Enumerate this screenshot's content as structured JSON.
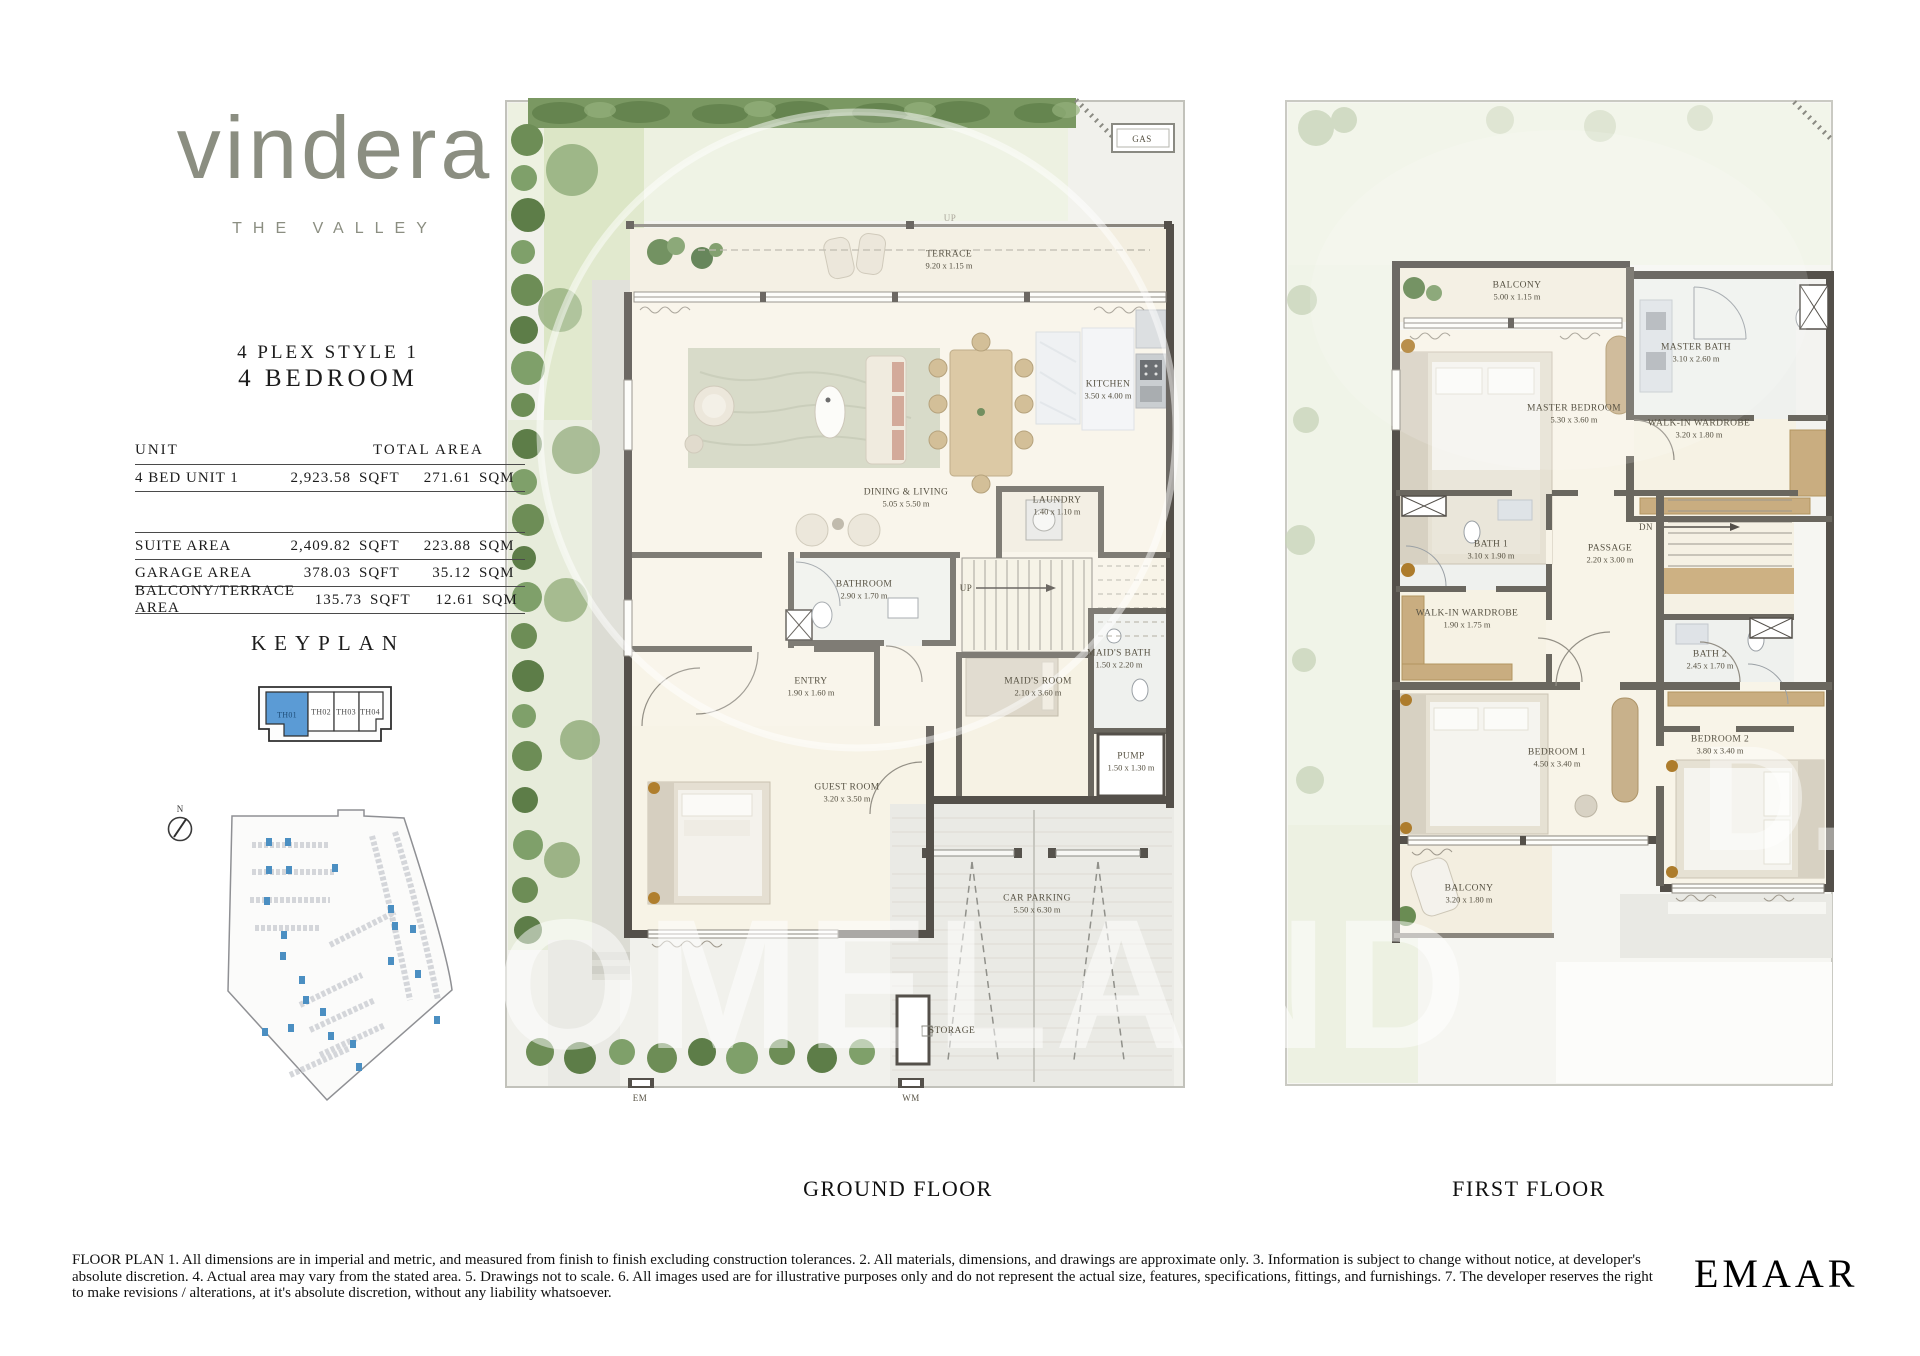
{
  "brand": {
    "logo": "vindera",
    "tagline": "THE VALLEY"
  },
  "header": {
    "style_line": "4 PLEX STYLE 1",
    "type_line": "4 BEDROOM"
  },
  "area_table": {
    "unit_header": "UNIT",
    "total_header": "TOTAL AREA",
    "unit_row": {
      "label": "4 BED UNIT 1",
      "sqft": "2,923.58",
      "sqft_unit": "SQFT",
      "sqm": "271.61",
      "sqm_unit": "SQM"
    },
    "detail_rows": [
      {
        "label": "SUITE AREA",
        "sqft": "2,409.82",
        "sqft_unit": "SQFT",
        "sqm": "223.88",
        "sqm_unit": "SQM"
      },
      {
        "label": "GARAGE AREA",
        "sqft": "378.03",
        "sqft_unit": "SQFT",
        "sqm": "35.12",
        "sqm_unit": "SQM"
      },
      {
        "label": "BALCONY/TERRACE AREA",
        "sqft": "135.73",
        "sqft_unit": "SQFT",
        "sqm": "12.61",
        "sqm_unit": "SQM"
      }
    ]
  },
  "keyplan": {
    "title": "KEYPLAN",
    "units": [
      {
        "id": "TH01"
      },
      {
        "id": "TH02"
      },
      {
        "id": "TH03"
      },
      {
        "id": "TH04"
      }
    ],
    "highlighted_unit": "TH01",
    "highlight_color": "#5b9bd5"
  },
  "compass": {
    "label": "N"
  },
  "ground_floor": {
    "title": "GROUND FLOOR",
    "rooms": [
      {
        "name": "TERRACE",
        "dims": "9.20 x 1.15 m"
      },
      {
        "name": "KITCHEN",
        "dims": "3.50 x 4.00 m"
      },
      {
        "name": "DINING & LIVING",
        "dims": "5.05 x 5.50 m"
      },
      {
        "name": "LAUNDRY",
        "dims": "1.40 x 1.10 m"
      },
      {
        "name": "BATHROOM",
        "dims": "2.90 x 1.70 m"
      },
      {
        "name": "ENTRY",
        "dims": "1.90 x 1.60 m"
      },
      {
        "name": "MAID'S ROOM",
        "dims": "2.10 x 3.60 m"
      },
      {
        "name": "MAID'S BATH",
        "dims": "1.50 x 2.20 m"
      },
      {
        "name": "PUMP",
        "dims": "1.50 x 1.30 m"
      },
      {
        "name": "GUEST ROOM",
        "dims": "3.20 x 3.50 m"
      },
      {
        "name": "CAR PARKING",
        "dims": "5.50 x 6.30 m"
      },
      {
        "name": "STORAGE"
      }
    ],
    "annotations": {
      "gas": "GAS",
      "up": "UP",
      "up_terrace": "UP",
      "em": "EM",
      "wm": "WM"
    }
  },
  "first_floor": {
    "title": "FIRST FLOOR",
    "rooms": [
      {
        "name": "BALCONY",
        "dims": "5.00 x 1.15 m"
      },
      {
        "name": "MASTER BATH",
        "dims": "3.10 x 2.60 m"
      },
      {
        "name": "MASTER BEDROOM",
        "dims": "5.30 x 3.60 m"
      },
      {
        "name": "WALK-IN WARDROBE",
        "dims": "3.20 x 1.80 m"
      },
      {
        "name": "BATH 1",
        "dims": "3.10 x 1.90 m"
      },
      {
        "name": "PASSAGE",
        "dims": "2.20 x 3.00 m"
      },
      {
        "name": "WALK-IN WARDROBE",
        "dims": "1.90 x 1.75 m"
      },
      {
        "name": "BATH 2",
        "dims": "2.45 x 1.70 m"
      },
      {
        "name": "BEDROOM 1",
        "dims": "4.50 x 3.40 m"
      },
      {
        "name": "BEDROOM 2",
        "dims": "3.80 x 3.40 m"
      },
      {
        "name": "BALCONY",
        "dims": "3.20 x 1.80 m"
      }
    ],
    "annotations": {
      "dn": "DN"
    }
  },
  "watermark": {
    "text_main": "OMELAND",
    "text_side": "D."
  },
  "footer": {
    "disclaimer": "FLOOR PLAN 1. All dimensions are in imperial and metric, and measured from finish to finish excluding construction tolerances. 2. All materials, dimensions, and drawings are approximate only. 3. Information is subject to change without notice, at developer's absolute discretion. 4. Actual area may vary from the stated area. 5. Drawings not to scale. 6. All images used are for illustrative purposes only and do not represent the actual size, features, specifications, fittings, and furnishings. 7. The developer reserves the right to make revisions / alterations, at it's absolute discretion, without any liability whatsoever.",
    "brand": "EMAAR"
  }
}
